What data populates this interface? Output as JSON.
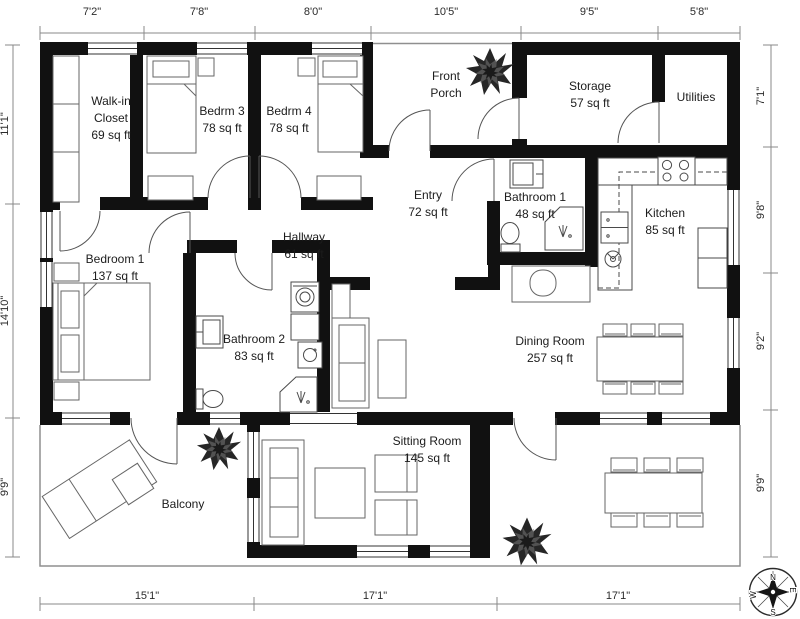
{
  "title": "2D Floor Plan",
  "rooms": [
    {
      "id": "walk-in-closet",
      "line1": "Walk-in",
      "line2": "Closet",
      "line3": "69 sq ft"
    },
    {
      "id": "bedrm-3",
      "line1": "Bedrm 3",
      "line2": "78 sq ft"
    },
    {
      "id": "bedrm-4",
      "line1": "Bedrm 4",
      "line2": "78 sq ft"
    },
    {
      "id": "front-porch",
      "line1": "Front",
      "line2": "Porch"
    },
    {
      "id": "storage",
      "line1": "Storage",
      "line2": "57 sq ft"
    },
    {
      "id": "utilities",
      "line1": "Utilities"
    },
    {
      "id": "entry",
      "line1": "Entry",
      "line2": "72 sq ft"
    },
    {
      "id": "bathroom-1",
      "line1": "Bathroom 1",
      "line2": "48 sq ft"
    },
    {
      "id": "kitchen",
      "line1": "Kitchen",
      "line2": "85 sq ft"
    },
    {
      "id": "bedroom-1",
      "line1": "Bedroom 1",
      "line2": "137 sq ft"
    },
    {
      "id": "hallway",
      "line1": "Hallway",
      "line2": "61 sq ft"
    },
    {
      "id": "bathroom-2",
      "line1": "Bathroom 2",
      "line2": "83 sq ft"
    },
    {
      "id": "dining-room",
      "line1": "Dining Room",
      "line2": "257 sq ft"
    },
    {
      "id": "sitting-room",
      "line1": "Sitting Room",
      "line2": "145 sq ft"
    },
    {
      "id": "balcony",
      "line1": "Balcony"
    }
  ],
  "dims": {
    "top": [
      "7'2\"",
      "7'8\"",
      "8'0\"",
      "10'5\"",
      "9'5\"",
      "5'8\""
    ],
    "bottom": [
      "15'1\"",
      "17'1\"",
      "17'1\""
    ],
    "left": [
      "11'1\"",
      "14'10\"",
      "9'9\""
    ],
    "right": [
      "7'1\"",
      "9'8\"",
      "9'2\"",
      "9'9\""
    ]
  },
  "compass": {
    "n": "N",
    "e": "E",
    "s": "S",
    "w": "W"
  },
  "colors": {
    "walls": "#111111",
    "furniture_outline": "#666666",
    "dimension_lines": "#888888",
    "plant": "#262626"
  }
}
